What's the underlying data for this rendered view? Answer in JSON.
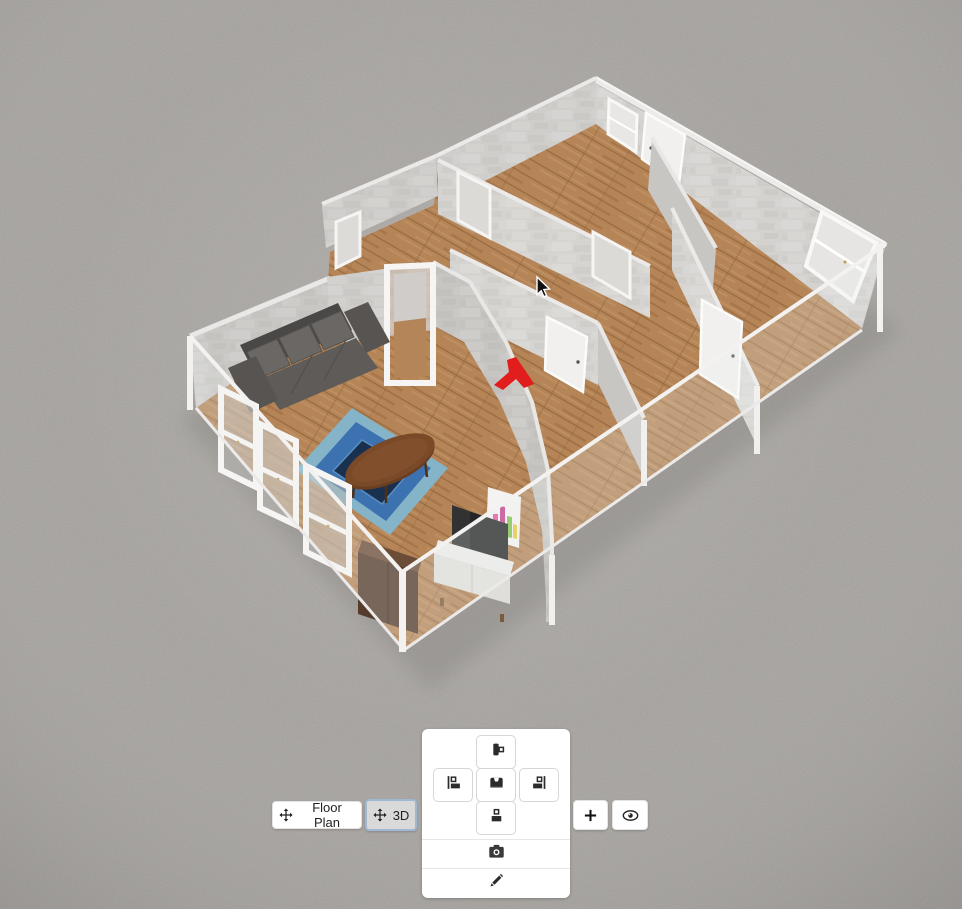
{
  "view_switcher": {
    "floor_plan": {
      "label": "Floor Plan",
      "icon": "move-icon",
      "selected": false
    },
    "three_d": {
      "label": "3D",
      "icon": "move-icon",
      "selected": true,
      "selected_border_color": "#9fb8d4"
    }
  },
  "right_buttons": {
    "add": {
      "icon": "plus-icon"
    },
    "visibility": {
      "icon": "eye-icon"
    }
  },
  "placement_panel": {
    "cross_buttons": {
      "up": {
        "icon": "furniture-align-top-icon"
      },
      "left": {
        "icon": "furniture-align-left-icon"
      },
      "center": {
        "icon": "armchair-icon"
      },
      "right": {
        "icon": "furniture-align-right-icon"
      },
      "down": {
        "icon": "furniture-align-bottom-icon"
      }
    },
    "camera": {
      "icon": "camera-icon"
    },
    "draw": {
      "icon": "pencil-icon"
    }
  },
  "scene": {
    "type": "3d-floor-plan-view",
    "colors": {
      "ground": "#a7a4a0",
      "wall_stone": "#d3d1ce",
      "wall_stone_shaded": "#c6c4c1",
      "floor_wood": "#b58557",
      "glass_rail": "#f3f2f0",
      "sofa": "#5e5b58",
      "rug_outer": "#85b4c8",
      "rug_mid": "#3d72b0",
      "rug_center": "#19304f",
      "coffee_table": "#7a4a28",
      "wardrobe": "#543b2b",
      "tv_cabinet": "#ecebe9",
      "tv_screen": "#333232",
      "poster_pink": "#e0559f",
      "poster_green": "#7bc24a",
      "marker_red": "#e11d1d",
      "door": "#f1f0ee"
    },
    "cursor": {
      "x": 536,
      "y": 276
    }
  }
}
